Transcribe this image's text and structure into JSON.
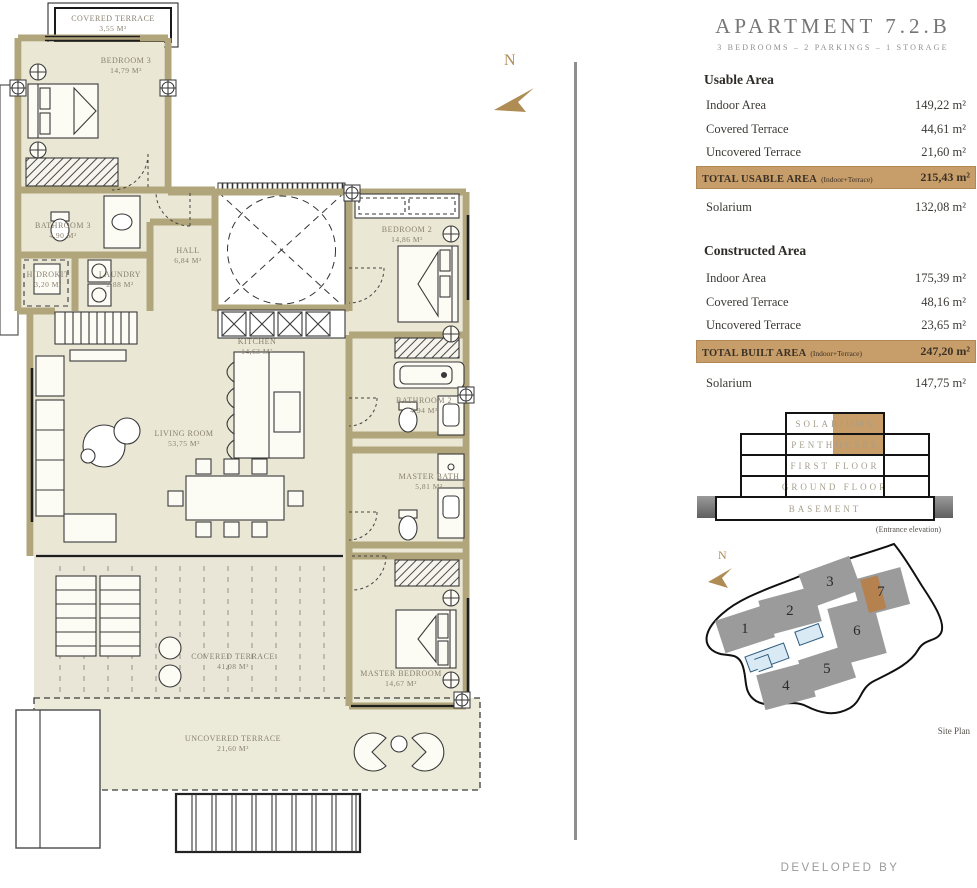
{
  "plan": {
    "north_label": "N",
    "rooms": [
      {
        "name": "COVERED TERRACE",
        "area": "3,55 m²"
      },
      {
        "name": "BEDROOM 3",
        "area": "14,79 m²"
      },
      {
        "name": "BATHROOM 3",
        "area": "4,90 m²"
      },
      {
        "name": "HIDROKIT",
        "area": "3,20 m²"
      },
      {
        "name": "LAUNDRY",
        "area": "2,88 m²"
      },
      {
        "name": "HALL",
        "area": "6,84 m²"
      },
      {
        "name": "KITCHEN",
        "area": "14,63 m²"
      },
      {
        "name": "LIVING ROOM",
        "area": "53,75 m²"
      },
      {
        "name": "BEDROOM 2",
        "area": "14,86 m²"
      },
      {
        "name": "BATHROOM 2",
        "area": "4,94 m²"
      },
      {
        "name": "MASTER BATH",
        "area": "5,81 m²"
      },
      {
        "name": "MASTER BEDROOM",
        "area": "14,67 m²"
      },
      {
        "name": "COVERED TERRACE",
        "area": "41,08 m²"
      },
      {
        "name": "UNCOVERED TERRACE",
        "area": "21,60 m²"
      }
    ]
  },
  "panel": {
    "title": "APARTMENT 7.2.B",
    "subtitle": "3 BEDROOMS – 2 PARKINGS – 1 STORAGE",
    "usable": {
      "heading": "Usable Area",
      "rows": [
        {
          "label": "Indoor Area",
          "value": "149,22 m²"
        },
        {
          "label": "Covered Terrace",
          "value": "44,61 m²"
        },
        {
          "label": "Uncovered Terrace",
          "value": "21,60 m²"
        }
      ],
      "total_label": "TOTAL USABLE AREA",
      "total_note": "(Indoor+Terrace)",
      "total_value": "215,43 m²",
      "solarium_label": "Solarium",
      "solarium_value": "132,08 m²"
    },
    "constructed": {
      "heading": "Constructed Area",
      "rows": [
        {
          "label": "Indoor Area",
          "value": "175,39 m²"
        },
        {
          "label": "Covered Terrace",
          "value": "48,16 m²"
        },
        {
          "label": "Uncovered Terrace",
          "value": "23,65 m²"
        }
      ],
      "total_label": "TOTAL BUILT AREA",
      "total_note": "(Indoor+Terrace)",
      "total_value": "247,20 m²",
      "solarium_label": "Solarium",
      "solarium_value": "147,75 m²"
    },
    "elevation": {
      "floors": [
        "SOLARIUMS",
        "PENTHOUSES",
        "FIRST FLOOR",
        "GROUND FLOOR",
        "BASEMENT"
      ],
      "caption": "(Entrance elevation)"
    },
    "site": {
      "north_label": "N",
      "buildings": [
        "1",
        "2",
        "3",
        "4",
        "5",
        "6",
        "7"
      ],
      "highlighted_building": "7",
      "caption": "Site Plan"
    }
  },
  "footer": {
    "developed_by": "DEVELOPED BY"
  },
  "colors": {
    "accent": "#c79d6a",
    "wall": "#b1a67b",
    "building_gray": "#9b9b9b",
    "pool": "#d9eaf5",
    "north": "#b08c55"
  }
}
